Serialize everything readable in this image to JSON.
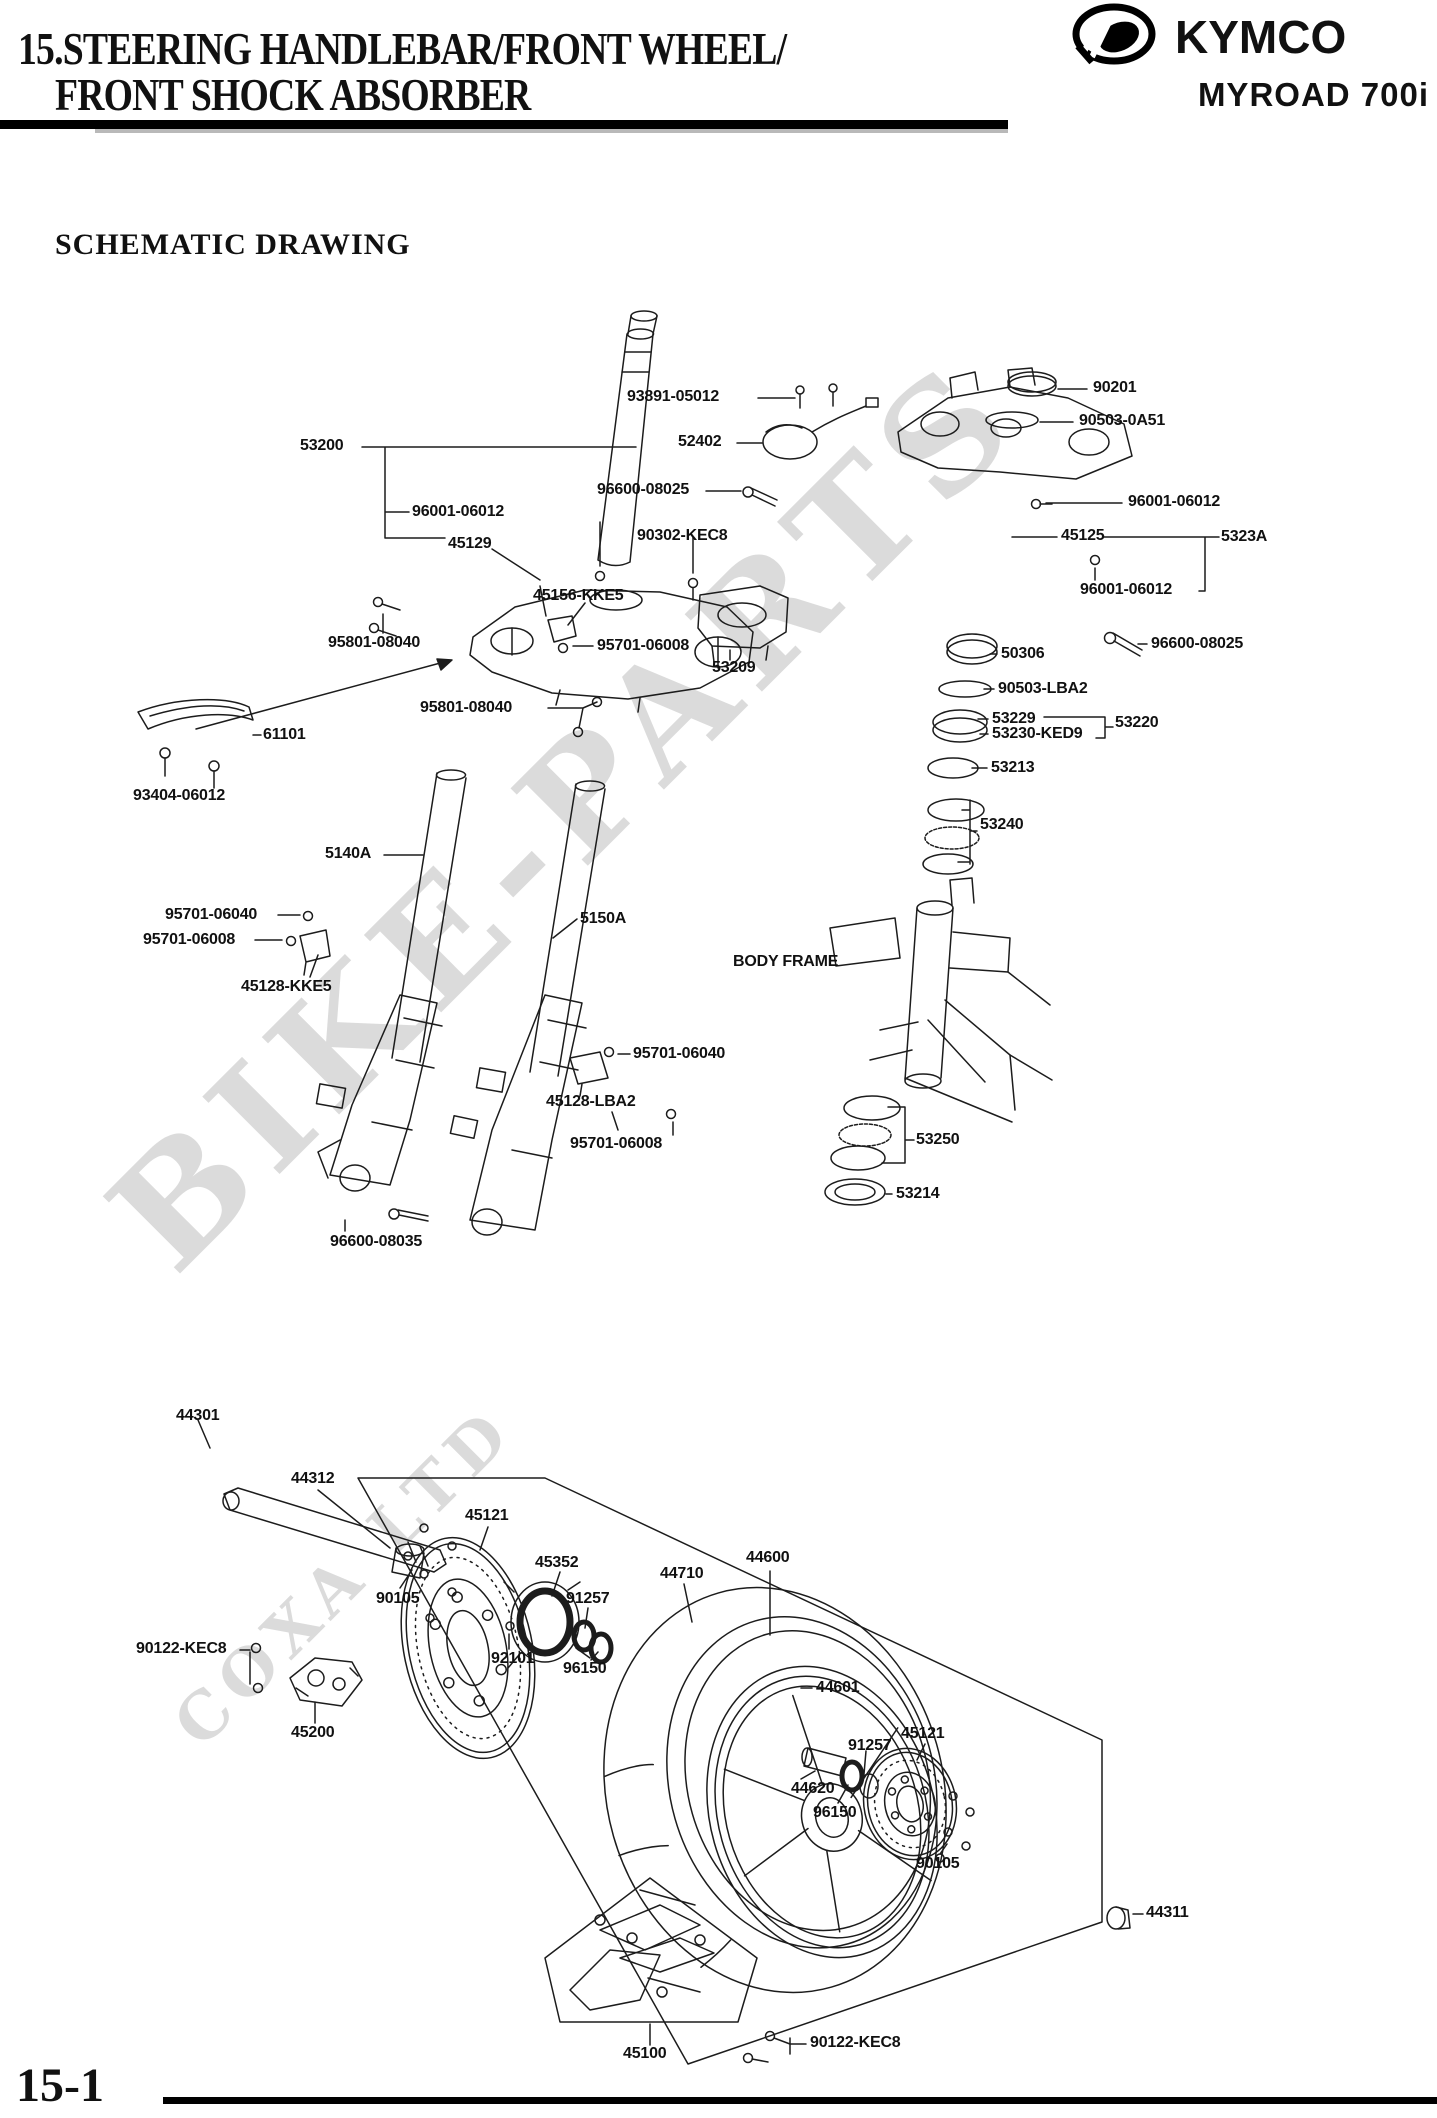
{
  "header": {
    "title_line1": "15.STEERING HANDLEBAR/FRONT WHEEL/",
    "title_line2": "FRONT SHOCK ABSORBER",
    "brand": "KYMCO",
    "model": "MYROAD 700i"
  },
  "section_title": "SCHEMATIC DRAWING",
  "page_number": "15-1",
  "watermark": {
    "text": "BIKE-PARTS",
    "subtext": "COXA LTD"
  },
  "colors": {
    "ink": "#1c1c1c",
    "watermark": "#c6c6c6",
    "page": "#ffffff"
  },
  "diagram": {
    "labels": [
      {
        "text": "53200",
        "x": 300,
        "y": 438
      },
      {
        "text": "96001-06012",
        "x": 412,
        "y": 504
      },
      {
        "text": "45129",
        "x": 448,
        "y": 536
      },
      {
        "text": "93891-05012",
        "x": 627,
        "y": 389
      },
      {
        "text": "52402",
        "x": 678,
        "y": 434
      },
      {
        "text": "96600-08025",
        "x": 597,
        "y": 482
      },
      {
        "text": "90302-KEC8",
        "x": 637,
        "y": 528
      },
      {
        "text": "90201",
        "x": 1093,
        "y": 380
      },
      {
        "text": "90503-0A51",
        "x": 1079,
        "y": 413
      },
      {
        "text": "96001-06012",
        "x": 1128,
        "y": 494
      },
      {
        "text": "45125",
        "x": 1061,
        "y": 528
      },
      {
        "text": "5323A",
        "x": 1221,
        "y": 529
      },
      {
        "text": "96001-06012",
        "x": 1080,
        "y": 582
      },
      {
        "text": "45156-KKE5",
        "x": 533,
        "y": 588
      },
      {
        "text": "95801-08040",
        "x": 328,
        "y": 635
      },
      {
        "text": "95701-06008",
        "x": 597,
        "y": 638
      },
      {
        "text": "53209",
        "x": 712,
        "y": 660
      },
      {
        "text": "50306",
        "x": 1001,
        "y": 646
      },
      {
        "text": "96600-08025",
        "x": 1151,
        "y": 636
      },
      {
        "text": "90503-LBA2",
        "x": 998,
        "y": 681
      },
      {
        "text": "53229",
        "x": 992,
        "y": 711
      },
      {
        "text": "53230-KED9",
        "x": 992,
        "y": 726
      },
      {
        "text": "53220",
        "x": 1115,
        "y": 715
      },
      {
        "text": "53213",
        "x": 991,
        "y": 760
      },
      {
        "text": "95801-08040",
        "x": 420,
        "y": 700
      },
      {
        "text": "61101",
        "x": 263,
        "y": 727
      },
      {
        "text": "93404-06012",
        "x": 133,
        "y": 788
      },
      {
        "text": "53240",
        "x": 980,
        "y": 817
      },
      {
        "text": "5140A",
        "x": 325,
        "y": 846
      },
      {
        "text": "95701-06040",
        "x": 165,
        "y": 907
      },
      {
        "text": "95701-06008",
        "x": 143,
        "y": 932
      },
      {
        "text": "45128-KKE5",
        "x": 241,
        "y": 979
      },
      {
        "text": "5150A",
        "x": 580,
        "y": 911
      },
      {
        "text": "BODY FRAME",
        "x": 733,
        "y": 954
      },
      {
        "text": "95701-06040",
        "x": 633,
        "y": 1046
      },
      {
        "text": "45128-LBA2",
        "x": 546,
        "y": 1094
      },
      {
        "text": "95701-06008",
        "x": 570,
        "y": 1136
      },
      {
        "text": "53250",
        "x": 916,
        "y": 1132
      },
      {
        "text": "53214",
        "x": 896,
        "y": 1186
      },
      {
        "text": "96600-08035",
        "x": 330,
        "y": 1234
      },
      {
        "text": "44301",
        "x": 176,
        "y": 1408
      },
      {
        "text": "44312",
        "x": 291,
        "y": 1471
      },
      {
        "text": "45121",
        "x": 465,
        "y": 1508
      },
      {
        "text": "45352",
        "x": 535,
        "y": 1555
      },
      {
        "text": "90105",
        "x": 376,
        "y": 1591
      },
      {
        "text": "91257",
        "x": 566,
        "y": 1591
      },
      {
        "text": "44710",
        "x": 660,
        "y": 1566
      },
      {
        "text": "44600",
        "x": 746,
        "y": 1550
      },
      {
        "text": "92101",
        "x": 491,
        "y": 1651
      },
      {
        "text": "96150",
        "x": 563,
        "y": 1661
      },
      {
        "text": "44601",
        "x": 816,
        "y": 1680
      },
      {
        "text": "90122-KEC8",
        "x": 136,
        "y": 1641
      },
      {
        "text": "45200",
        "x": 291,
        "y": 1725
      },
      {
        "text": "44620",
        "x": 791,
        "y": 1781
      },
      {
        "text": "91257",
        "x": 848,
        "y": 1738
      },
      {
        "text": "45121",
        "x": 901,
        "y": 1726
      },
      {
        "text": "96150",
        "x": 813,
        "y": 1805
      },
      {
        "text": "90105",
        "x": 916,
        "y": 1856
      },
      {
        "text": "44311",
        "x": 1146,
        "y": 1905
      },
      {
        "text": "45100",
        "x": 623,
        "y": 2046
      },
      {
        "text": "90122-KEC8",
        "x": 810,
        "y": 2035
      }
    ]
  }
}
